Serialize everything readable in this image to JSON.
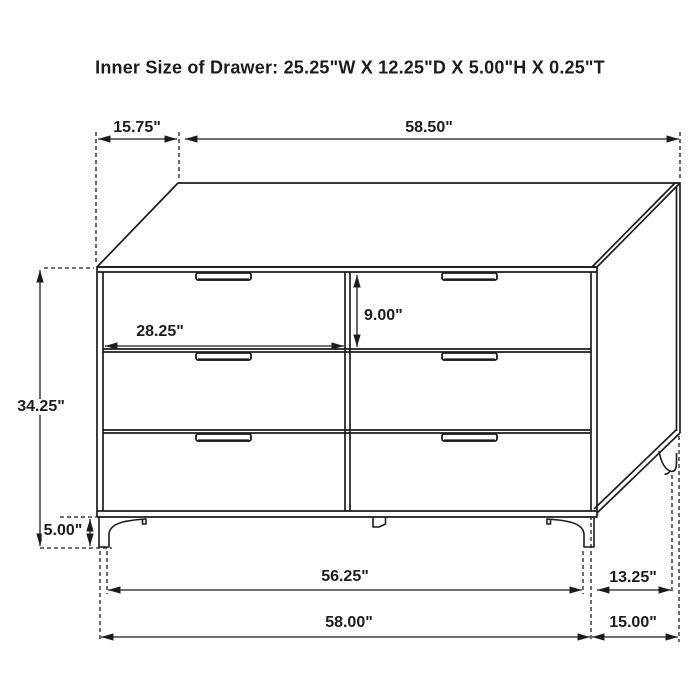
{
  "title": "Inner Size of Drawer: 25.25\"W X 12.25\"D X 5.00\"H X 0.25\"T",
  "dimensions": {
    "top_depth": "15.75\"",
    "top_width": "58.50\"",
    "drawer_width": "28.25\"",
    "drawer_height": "9.00\"",
    "overall_height": "34.25\"",
    "leg_height": "5.00\"",
    "front_leg_span": "56.25\"",
    "side_leg_span": "13.25\"",
    "front_width": "58.00\"",
    "side_depth": "15.00\""
  },
  "colors": {
    "line": "#1c1c1c",
    "background": "#ffffff",
    "text": "#1c1c1c"
  }
}
